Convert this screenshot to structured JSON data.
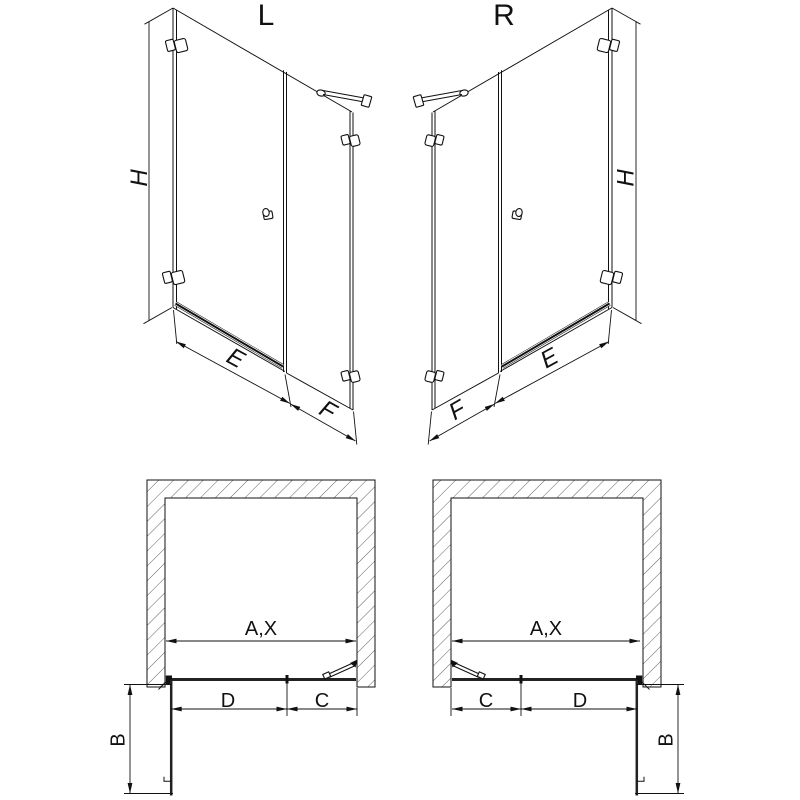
{
  "views": {
    "front_left": {
      "label": "L",
      "height": "H",
      "door_width": "E",
      "panel_width": "F"
    },
    "front_right": {
      "label": "R",
      "height": "H",
      "door_width": "E",
      "panel_width": "F"
    },
    "plan_left": {
      "opening_width": "A,X",
      "door_width": "D",
      "panel_width": "C",
      "door_swing": "B"
    },
    "plan_right": {
      "opening_width": "A,X",
      "door_width": "D",
      "panel_width": "C",
      "door_swing": "B"
    }
  },
  "colors": {
    "line": "#111111",
    "background": "#ffffff"
  }
}
